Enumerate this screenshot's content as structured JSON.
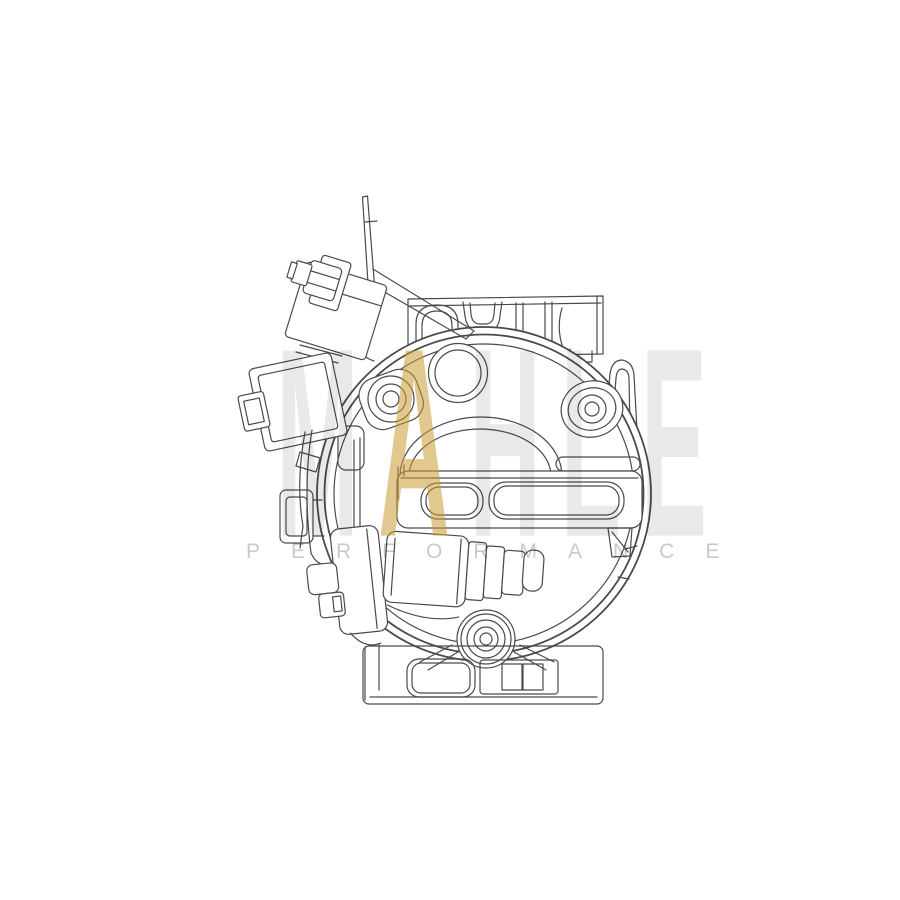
{
  "canvas": {
    "background_color": "#ffffff",
    "width": 900,
    "height": 900
  },
  "artwork": {
    "kind": "technical-line-drawing",
    "subject": "AC compressor front view",
    "line_color": "#4a4a4a"
  },
  "watermark": {
    "brand_letters": [
      {
        "char": "M",
        "color": "rgba(0,0,0,0.085)"
      },
      {
        "char": "A",
        "color": "rgba(201,154,51,0.55)"
      },
      {
        "char": "H",
        "color": "rgba(0,0,0,0.085)"
      },
      {
        "char": "L",
        "color": "rgba(0,0,0,0.085)"
      },
      {
        "char": "E",
        "color": "rgba(0,0,0,0.085)"
      }
    ],
    "tagline": "PERFORMANCE",
    "tagline_color": "rgba(0,0,0,0.21)",
    "gold_color": "rgba(201,154,51,0.55)",
    "gray_color": "rgba(0,0,0,0.085)"
  }
}
